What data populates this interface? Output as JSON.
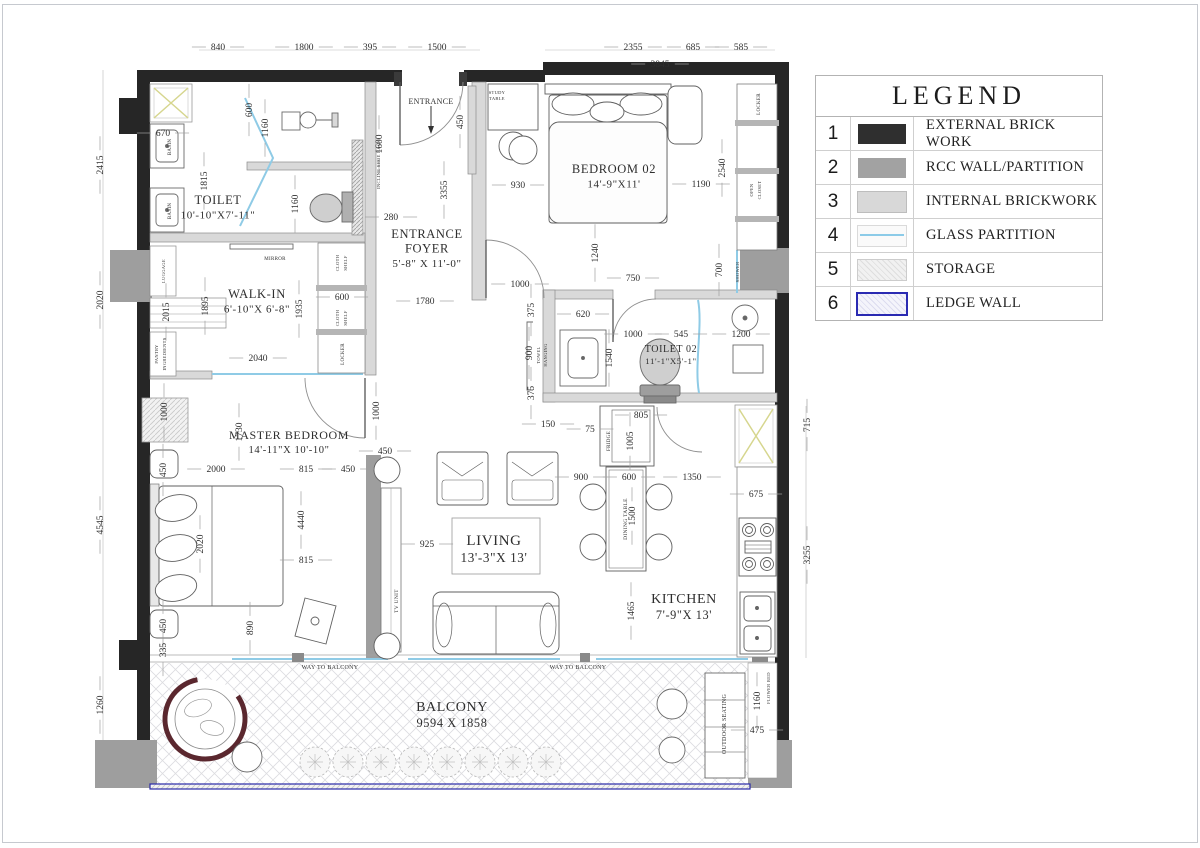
{
  "legend": {
    "title": "LEGEND",
    "items": [
      {
        "num": "1",
        "label": "EXTERNAL BRICK WORK",
        "swatch": "solid-dark"
      },
      {
        "num": "2",
        "label": "RCC WALL/PARTITION",
        "swatch": "solid-gray"
      },
      {
        "num": "3",
        "label": "INTERNAL BRICKWORK",
        "swatch": "solid-light"
      },
      {
        "num": "4",
        "label": "GLASS PARTITION",
        "swatch": "glass-line"
      },
      {
        "num": "5",
        "label": "STORAGE",
        "swatch": "hatch"
      },
      {
        "num": "6",
        "label": "LEDGE WALL",
        "swatch": "ledge"
      }
    ]
  },
  "rooms": [
    {
      "lines": [
        "TOILET",
        "10'-10\"X7'-11\""
      ],
      "x": 218,
      "y": 201,
      "f": 12.5
    },
    {
      "lines": [
        "WALK-IN",
        "6'-10\"X 6'-8\""
      ],
      "x": 257,
      "y": 295,
      "f": 12.5
    },
    {
      "lines": [
        "ENTRANCE",
        "FOYER",
        "5'-8\" X 11'-0\""
      ],
      "x": 427,
      "y": 235,
      "f": 12.5
    },
    {
      "lines": [
        "BEDROOM 02",
        "14'-9\"X11'"
      ],
      "x": 614,
      "y": 170,
      "f": 12.5
    },
    {
      "lines": [
        "TOILET 02",
        "11'-1\"X5'-1\""
      ],
      "x": 671,
      "y": 349,
      "f": 10
    },
    {
      "lines": [
        "MASTER BEDROOM",
        "14'-11\"X 10'-10\""
      ],
      "x": 289,
      "y": 436,
      "f": 12
    },
    {
      "lines": [
        "LIVING",
        "13'-3\"X 13'"
      ],
      "x": 494,
      "y": 542,
      "f": 15
    },
    {
      "lines": [
        "KITCHEN",
        "7'-9\"X 13'"
      ],
      "x": 684,
      "y": 600,
      "f": 14
    },
    {
      "lines": [
        "BALCONY",
        "9594 X 1858"
      ],
      "x": 452,
      "y": 708,
      "f": 14
    }
  ],
  "dims": [
    {
      "v": "840",
      "x": 218,
      "y": 47,
      "o": "h"
    },
    {
      "v": "1800",
      "x": 304,
      "y": 47,
      "o": "h"
    },
    {
      "v": "395",
      "x": 370,
      "y": 47,
      "o": "h"
    },
    {
      "v": "1500",
      "x": 437,
      "y": 47,
      "o": "h"
    },
    {
      "v": "2355",
      "x": 633,
      "y": 47,
      "o": "h"
    },
    {
      "v": "685",
      "x": 693,
      "y": 47,
      "o": "h"
    },
    {
      "v": "585",
      "x": 741,
      "y": 47,
      "o": "h"
    },
    {
      "v": "3845",
      "x": 660,
      "y": 64,
      "o": "h"
    },
    {
      "v": "2415",
      "x": 100,
      "y": 165,
      "o": "v"
    },
    {
      "v": "2020",
      "x": 100,
      "y": 300,
      "o": "v"
    },
    {
      "v": "4545",
      "x": 100,
      "y": 525,
      "o": "v"
    },
    {
      "v": "1260",
      "x": 100,
      "y": 705,
      "o": "v"
    },
    {
      "v": "715",
      "x": 807,
      "y": 425,
      "o": "v"
    },
    {
      "v": "3255",
      "x": 807,
      "y": 555,
      "o": "v"
    },
    {
      "v": "670",
      "x": 163,
      "y": 133,
      "o": "h"
    },
    {
      "v": "600",
      "x": 249,
      "y": 110,
      "o": "v"
    },
    {
      "v": "1160",
      "x": 265,
      "y": 128,
      "o": "v"
    },
    {
      "v": "1815",
      "x": 204,
      "y": 181,
      "o": "v"
    },
    {
      "v": "1160",
      "x": 295,
      "y": 204,
      "o": "v"
    },
    {
      "v": "280",
      "x": 391,
      "y": 217,
      "o": "h"
    },
    {
      "v": "3355",
      "x": 444,
      "y": 190,
      "o": "v"
    },
    {
      "v": "1600",
      "x": 379,
      "y": 144,
      "o": "v"
    },
    {
      "v": "450",
      "x": 460,
      "y": 122,
      "o": "v"
    },
    {
      "v": "930",
      "x": 518,
      "y": 185,
      "o": "h"
    },
    {
      "v": "1190",
      "x": 701,
      "y": 184,
      "o": "h"
    },
    {
      "v": "2540",
      "x": 722,
      "y": 168,
      "o": "v"
    },
    {
      "v": "1240",
      "x": 595,
      "y": 253,
      "o": "v"
    },
    {
      "v": "750",
      "x": 633,
      "y": 278,
      "o": "h"
    },
    {
      "v": "700",
      "x": 719,
      "y": 270,
      "o": "v"
    },
    {
      "v": "1895",
      "x": 205,
      "y": 306,
      "o": "v"
    },
    {
      "v": "1935",
      "x": 299,
      "y": 309,
      "o": "v"
    },
    {
      "v": "2015",
      "x": 166,
      "y": 312,
      "o": "v"
    },
    {
      "v": "600",
      "x": 342,
      "y": 297,
      "o": "h"
    },
    {
      "v": "2040",
      "x": 258,
      "y": 358,
      "o": "h"
    },
    {
      "v": "1780",
      "x": 425,
      "y": 301,
      "o": "h"
    },
    {
      "v": "1000",
      "x": 520,
      "y": 284,
      "o": "h"
    },
    {
      "v": "620",
      "x": 583,
      "y": 314,
      "o": "h"
    },
    {
      "v": "1000",
      "x": 633,
      "y": 334,
      "o": "h"
    },
    {
      "v": "545",
      "x": 681,
      "y": 334,
      "o": "h"
    },
    {
      "v": "1200",
      "x": 741,
      "y": 334,
      "o": "h"
    },
    {
      "v": "1540",
      "x": 609,
      "y": 358,
      "o": "v"
    },
    {
      "v": "375",
      "x": 531,
      "y": 310,
      "o": "v"
    },
    {
      "v": "900",
      "x": 529,
      "y": 353,
      "o": "v"
    },
    {
      "v": "375",
      "x": 531,
      "y": 393,
      "o": "v"
    },
    {
      "v": "150",
      "x": 548,
      "y": 424,
      "o": "h"
    },
    {
      "v": "75",
      "x": 590,
      "y": 429,
      "o": "h"
    },
    {
      "v": "805",
      "x": 641,
      "y": 415,
      "o": "h"
    },
    {
      "v": "1005",
      "x": 630,
      "y": 441,
      "o": "v"
    },
    {
      "v": "1730",
      "x": 239,
      "y": 432,
      "o": "v"
    },
    {
      "v": "1000",
      "x": 164,
      "y": 412,
      "o": "v"
    },
    {
      "v": "1000",
      "x": 376,
      "y": 411,
      "o": "v"
    },
    {
      "v": "450",
      "x": 385,
      "y": 451,
      "o": "h"
    },
    {
      "v": "2000",
      "x": 216,
      "y": 469,
      "o": "h"
    },
    {
      "v": "815",
      "x": 306,
      "y": 469,
      "o": "h"
    },
    {
      "v": "450",
      "x": 348,
      "y": 469,
      "o": "h"
    },
    {
      "v": "4440",
      "x": 301,
      "y": 520,
      "o": "v"
    },
    {
      "v": "2020",
      "x": 200,
      "y": 544,
      "o": "v"
    },
    {
      "v": "815",
      "x": 306,
      "y": 560,
      "o": "h"
    },
    {
      "v": "890",
      "x": 250,
      "y": 628,
      "o": "v"
    },
    {
      "v": "450",
      "x": 163,
      "y": 470,
      "o": "v"
    },
    {
      "v": "450",
      "x": 163,
      "y": 626,
      "o": "v"
    },
    {
      "v": "335",
      "x": 163,
      "y": 650,
      "o": "v"
    },
    {
      "v": "925",
      "x": 427,
      "y": 544,
      "o": "h"
    },
    {
      "v": "900",
      "x": 581,
      "y": 477,
      "o": "h"
    },
    {
      "v": "600",
      "x": 629,
      "y": 477,
      "o": "h"
    },
    {
      "v": "1350",
      "x": 692,
      "y": 477,
      "o": "h"
    },
    {
      "v": "1500",
      "x": 632,
      "y": 516,
      "o": "v"
    },
    {
      "v": "1465",
      "x": 631,
      "y": 611,
      "o": "v"
    },
    {
      "v": "675",
      "x": 756,
      "y": 494,
      "o": "h"
    },
    {
      "v": "1160",
      "x": 757,
      "y": 701,
      "o": "v"
    },
    {
      "v": "475",
      "x": 757,
      "y": 730,
      "o": "h"
    }
  ],
  "annotations": [
    {
      "t": "BASIN",
      "x": 168,
      "y": 147,
      "r": -90,
      "s": 5
    },
    {
      "t": "BASIN",
      "x": 168,
      "y": 211,
      "r": -90,
      "s": 5
    },
    {
      "t": "LUGGAGE",
      "x": 162,
      "y": 271,
      "r": -90,
      "s": 4.5
    },
    {
      "t": "PANTRY",
      "x": 155,
      "y": 354,
      "r": -90,
      "s": 4.5
    },
    {
      "t": "INGREDIENTS",
      "x": 163,
      "y": 354,
      "r": -90,
      "s": 4.5
    },
    {
      "t": "MIRROR",
      "x": 275,
      "y": 257,
      "r": 0,
      "s": 5
    },
    {
      "t": "CLOTH",
      "x": 336,
      "y": 263,
      "r": -90,
      "s": 4.5
    },
    {
      "t": "SHELF",
      "x": 344,
      "y": 263,
      "r": -90,
      "s": 4.5
    },
    {
      "t": "CLOTH",
      "x": 336,
      "y": 318,
      "r": -90,
      "s": 4.5
    },
    {
      "t": "SHELF",
      "x": 344,
      "y": 318,
      "r": -90,
      "s": 4.5
    },
    {
      "t": "LOCKER",
      "x": 341,
      "y": 354,
      "r": -90,
      "s": 5
    },
    {
      "t": "INCLINE SHOE RACK",
      "x": 377,
      "y": 164,
      "r": -90,
      "s": 4.5
    },
    {
      "t": "ENTRANCE",
      "x": 431,
      "y": 101,
      "r": 0,
      "s": 8
    },
    {
      "t": "STUDY",
      "x": 497,
      "y": 91,
      "r": 0,
      "s": 4.5
    },
    {
      "t": "TABLE",
      "x": 497,
      "y": 97,
      "r": 0,
      "s": 4.5
    },
    {
      "t": "LOCKER",
      "x": 757,
      "y": 104,
      "r": -90,
      "s": 5
    },
    {
      "t": "OPEN",
      "x": 750,
      "y": 190,
      "r": -90,
      "s": 4.5
    },
    {
      "t": "CLOSET",
      "x": 758,
      "y": 190,
      "r": -90,
      "s": 4.5
    },
    {
      "t": "SHOWER",
      "x": 736,
      "y": 272,
      "r": -90,
      "s": 4.5
    },
    {
      "t": "TOWEL",
      "x": 537,
      "y": 355,
      "r": -90,
      "s": 4.5
    },
    {
      "t": "HANGING",
      "x": 544,
      "y": 355,
      "r": -90,
      "s": 4.5
    },
    {
      "t": "FRIDGE",
      "x": 607,
      "y": 441,
      "r": -90,
      "s": 5
    },
    {
      "t": "DINING TABLE",
      "x": 624,
      "y": 519,
      "r": -90,
      "s": 5.5
    },
    {
      "t": "TV UNIT",
      "x": 395,
      "y": 601,
      "r": -90,
      "s": 5.5
    },
    {
      "t": "WAY TO BALCONY",
      "x": 330,
      "y": 666,
      "r": 0,
      "s": 6
    },
    {
      "t": "WAY TO BALCONY",
      "x": 578,
      "y": 666,
      "r": 0,
      "s": 6
    },
    {
      "t": "OUTDOOR SEATING",
      "x": 723,
      "y": 724,
      "r": -90,
      "s": 6
    },
    {
      "t": "FLOWER BED",
      "x": 767,
      "y": 688,
      "r": -90,
      "s": 4.5
    }
  ]
}
